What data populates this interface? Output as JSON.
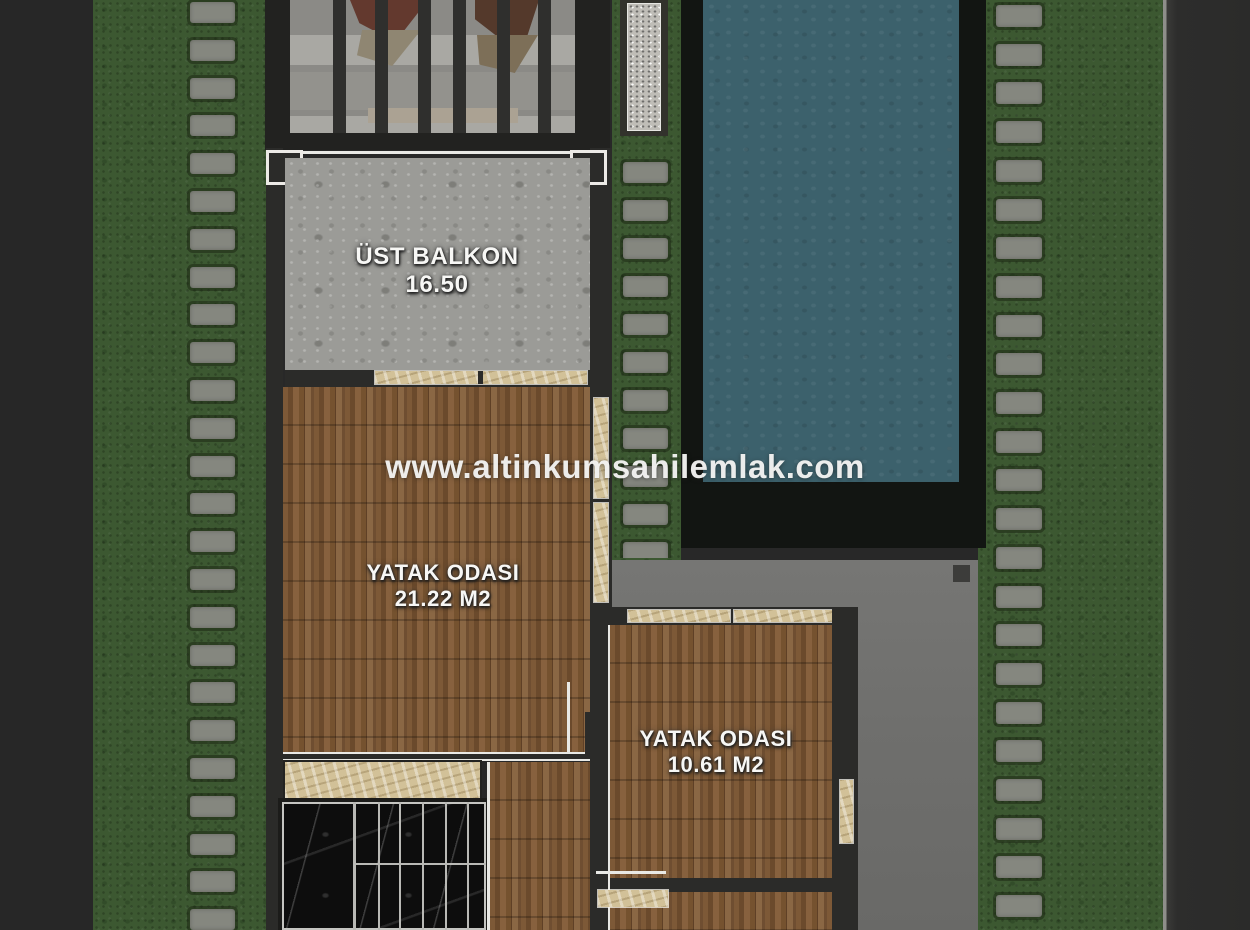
{
  "watermark": "www.altinkumsahilemlak.com",
  "rooms": {
    "balcony": {
      "name": "ÜST BALKON",
      "area": "16.50"
    },
    "bedroom1": {
      "name": "YATAK ODASI",
      "area": "21.22 M2"
    },
    "bedroom2": {
      "name": "YATAK ODASI",
      "area": "10.61 M2"
    }
  },
  "colors": {
    "background": "#282828",
    "grass": "#3c5831",
    "stepping_stone": "#85877f",
    "pool_water": "#3c616c",
    "pool_deck": "#121512",
    "wood_floor": "#7c5836",
    "balcony_concrete": "#9b9b97",
    "patio_concrete": "#6f6f6d",
    "marble_sill": "#d2c198",
    "stair_marble": "#0d0d0d",
    "wall": "#2b2b29",
    "label_text": "#f7f7f5"
  }
}
